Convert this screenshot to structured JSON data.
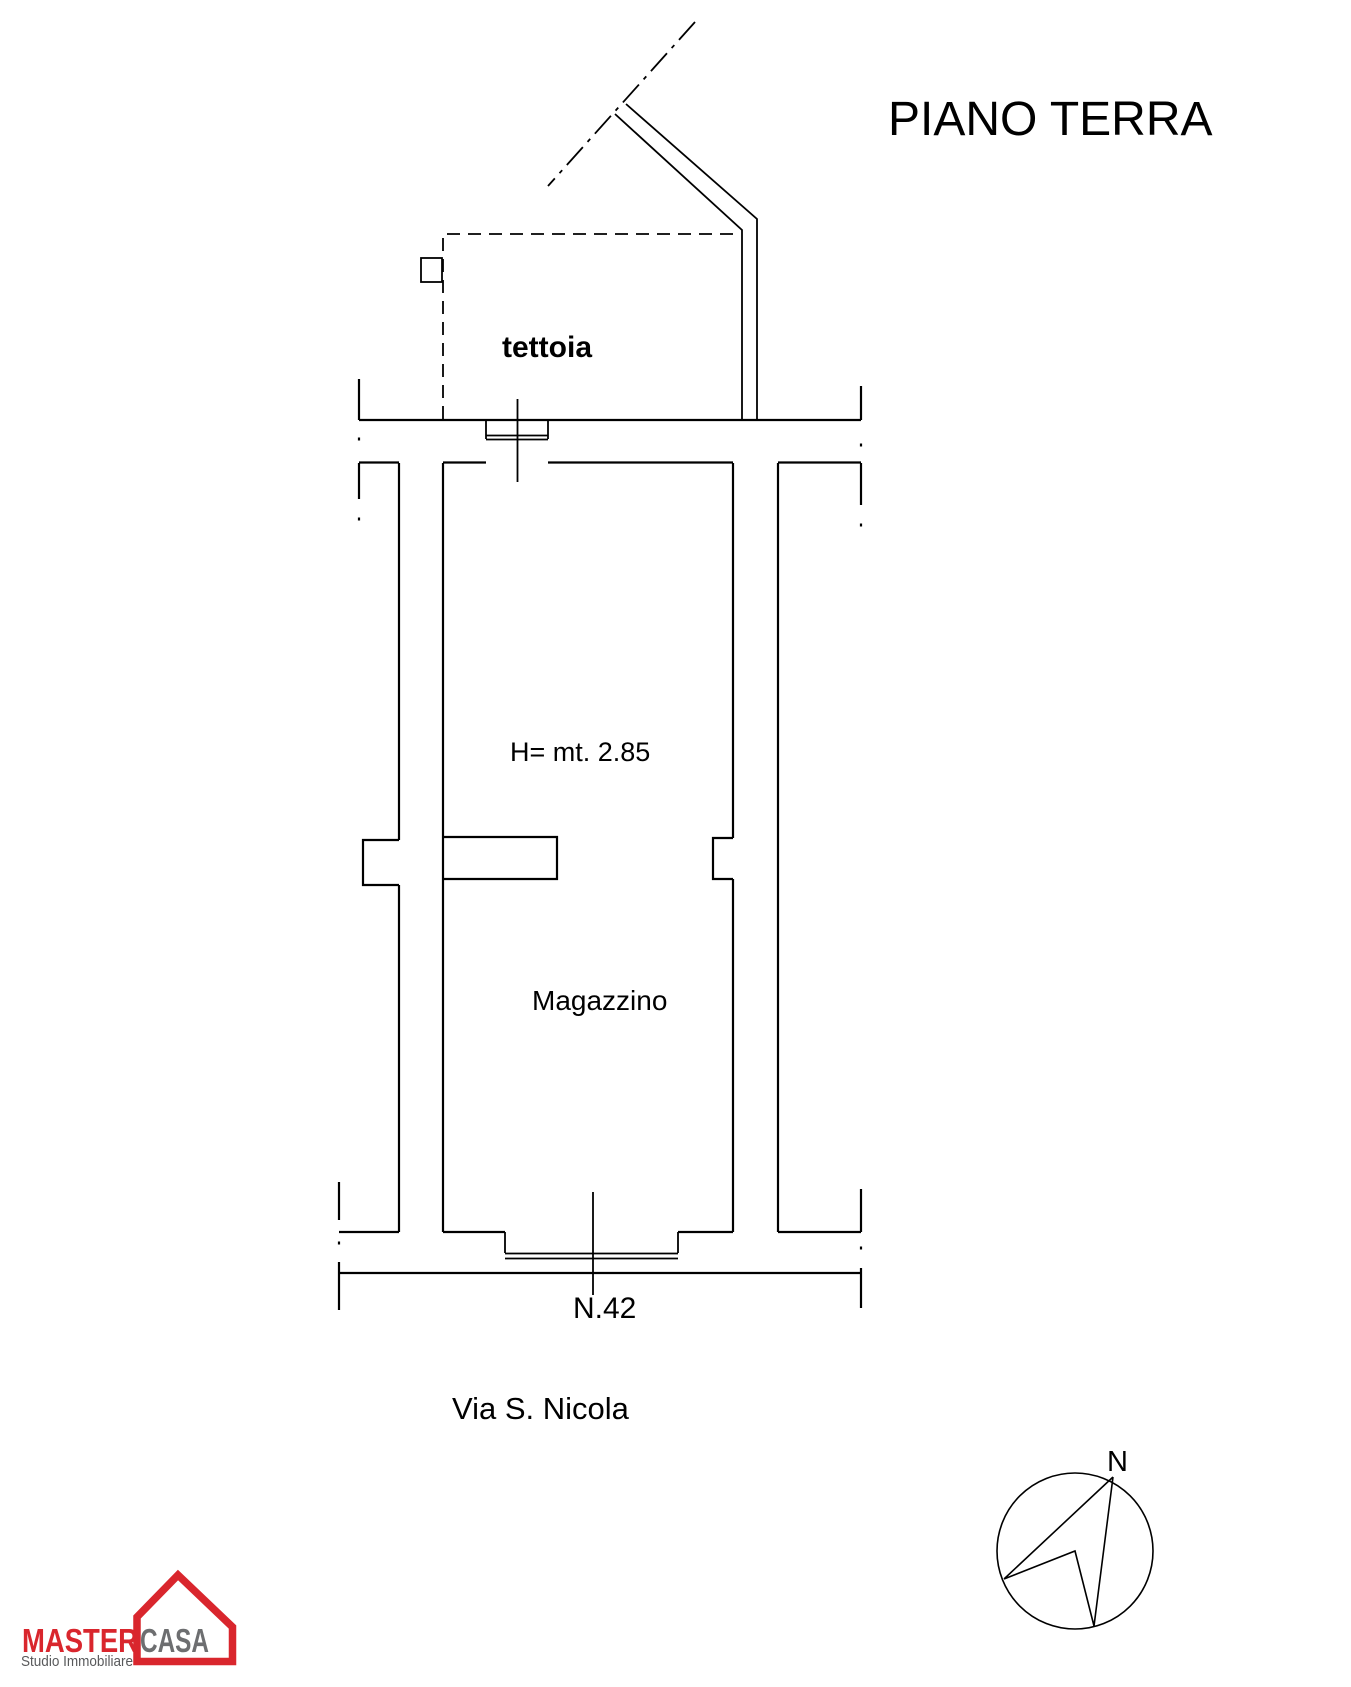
{
  "title": "PIANO TERRA",
  "plan": {
    "canopy_label": "tettoia",
    "height_label": "H= mt. 2.85",
    "room_label": "Magazzino",
    "street_number": "N.42",
    "street_name": "Via S. Nicola"
  },
  "compass": {
    "north_label": "N"
  },
  "logo": {
    "brand_primary": "MASTER",
    "brand_secondary": "CASA",
    "tagline": "Studio Immobiliare"
  },
  "colors": {
    "ink": "#000000",
    "background": "#ffffff",
    "logo_red": "#d9262d",
    "logo_gray": "#6d6e70",
    "logo_tagline_gray": "#58595b"
  }
}
